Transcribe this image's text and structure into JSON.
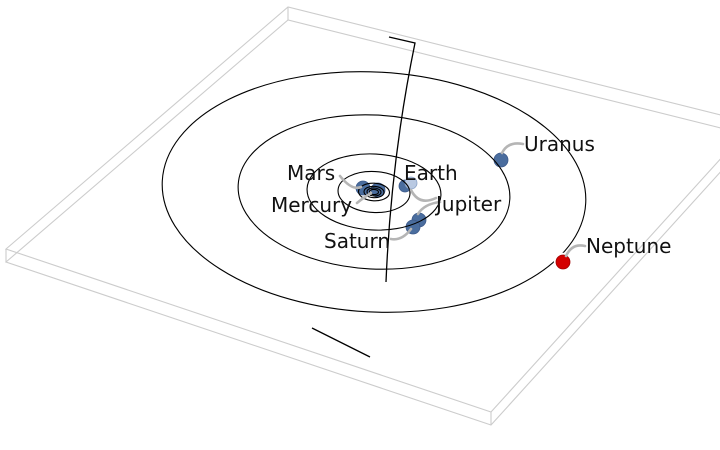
{
  "figure": {
    "description": "3D tilted view of the solar system: planetary orbits drawn on a thin white ecliptic-plane slab, with a steep trajectory line passing through the inner solar system",
    "width": 720,
    "height": 450,
    "background": "#ffffff"
  },
  "ecliptic_plane_box": {
    "edge_color": "#cccccc",
    "stroke_width": 1.1,
    "thickness_px": 13,
    "top_face_corners": [
      [
        6,
        249
      ],
      [
        288,
        7
      ],
      [
        753,
        123
      ],
      [
        491,
        412
      ]
    ]
  },
  "orbit_style": {
    "stroke_color": "#000000",
    "stroke_width": 1.1,
    "center": [
      374,
      192
    ],
    "tilt_deg": 3
  },
  "orbit_rings": [
    {
      "planet": "Mercury",
      "rx": 4.5,
      "ry": 2.6
    },
    {
      "planet": "Venus",
      "rx": 7,
      "ry": 4
    },
    {
      "planet": "Earth",
      "rx": 10,
      "ry": 5.7
    },
    {
      "planet": "Mars",
      "rx": 15.5,
      "ry": 8.8
    },
    {
      "planet": "Jupiter",
      "rx": 36,
      "ry": 20.5
    },
    {
      "planet": "Saturn",
      "rx": 67,
      "ry": 38
    },
    {
      "planet": "Uranus",
      "rx": 136,
      "ry": 77
    },
    {
      "planet": "Neptune",
      "rx": 212,
      "ry": 120
    }
  ],
  "trajectory": {
    "color": "#000000",
    "stroke_width": 1.3,
    "upper_path": "M 389 37 L 415 43 Q 391 160 386 282",
    "lower_path": "M 312 328 L 370 357"
  },
  "leader_style": {
    "color": "#b5b5b5",
    "width": 2.6
  },
  "label_style": {
    "color": "#111111",
    "font_size": 20
  },
  "planets": [
    {
      "name": "mars",
      "label": "Mars",
      "dot": {
        "x": 363,
        "y": 188,
        "r": 7,
        "color": "#4a6d9e",
        "edge": "#3d5a8a"
      },
      "label_pos": {
        "x": 287,
        "y": 180
      },
      "leader": "M 340 176 Q 352 191 361 187"
    },
    {
      "name": "mercury",
      "label": "Mercury",
      "dot": {
        "x": 378,
        "y": 190,
        "r": 7,
        "color": "#4a6d9e",
        "edge": "#3d5a8a"
      },
      "label_pos": {
        "x": 271,
        "y": 212
      },
      "leader": "M 357 203 Q 363 198 371 193"
    },
    {
      "name": "venus",
      "label": "",
      "dot": {
        "x": 405,
        "y": 186,
        "r": 6,
        "color": "#4a6d9e",
        "edge": "#3d5a8a"
      }
    },
    {
      "name": "earth",
      "label": "Earth",
      "dot": {
        "x": 411,
        "y": 183,
        "r": 6,
        "color": "#b9c9e2",
        "edge": "#8ba3c7"
      },
      "label_pos": {
        "x": 404,
        "y": 180
      },
      "leader": "M 436 198 Q 419 206 411 190"
    },
    {
      "name": "jupiter",
      "label": "Jupiter",
      "dot": {
        "x": 419,
        "y": 220,
        "r": 7,
        "color": "#4a6d9e",
        "edge": "#3d5a8a"
      },
      "label_pos": {
        "x": 436,
        "y": 211
      },
      "leader": "M 440 202 Q 424 204 418 214"
    },
    {
      "name": "saturn",
      "label": "Saturn",
      "dot": {
        "x": 413,
        "y": 227,
        "r": 7,
        "color": "#4a6d9e",
        "edge": "#3d5a8a"
      },
      "label_pos": {
        "x": 324,
        "y": 248
      },
      "leader": "M 391 239 Q 402 241 411 229"
    },
    {
      "name": "uranus",
      "label": "Uranus",
      "dot": {
        "x": 501,
        "y": 160,
        "r": 7,
        "color": "#4a6d9e",
        "edge": "#3d5a8a"
      },
      "label_pos": {
        "x": 524,
        "y": 151
      },
      "leader": "M 523 144 Q 508 141 502 153"
    },
    {
      "name": "neptune",
      "label": "Neptune",
      "dot": {
        "x": 563,
        "y": 262,
        "r": 7,
        "color": "#d40000",
        "edge": "#a00000",
        "halo": "#ffffff"
      },
      "label_pos": {
        "x": 586,
        "y": 253
      },
      "leader": "M 585 246 Q 572 243 566 256"
    }
  ]
}
